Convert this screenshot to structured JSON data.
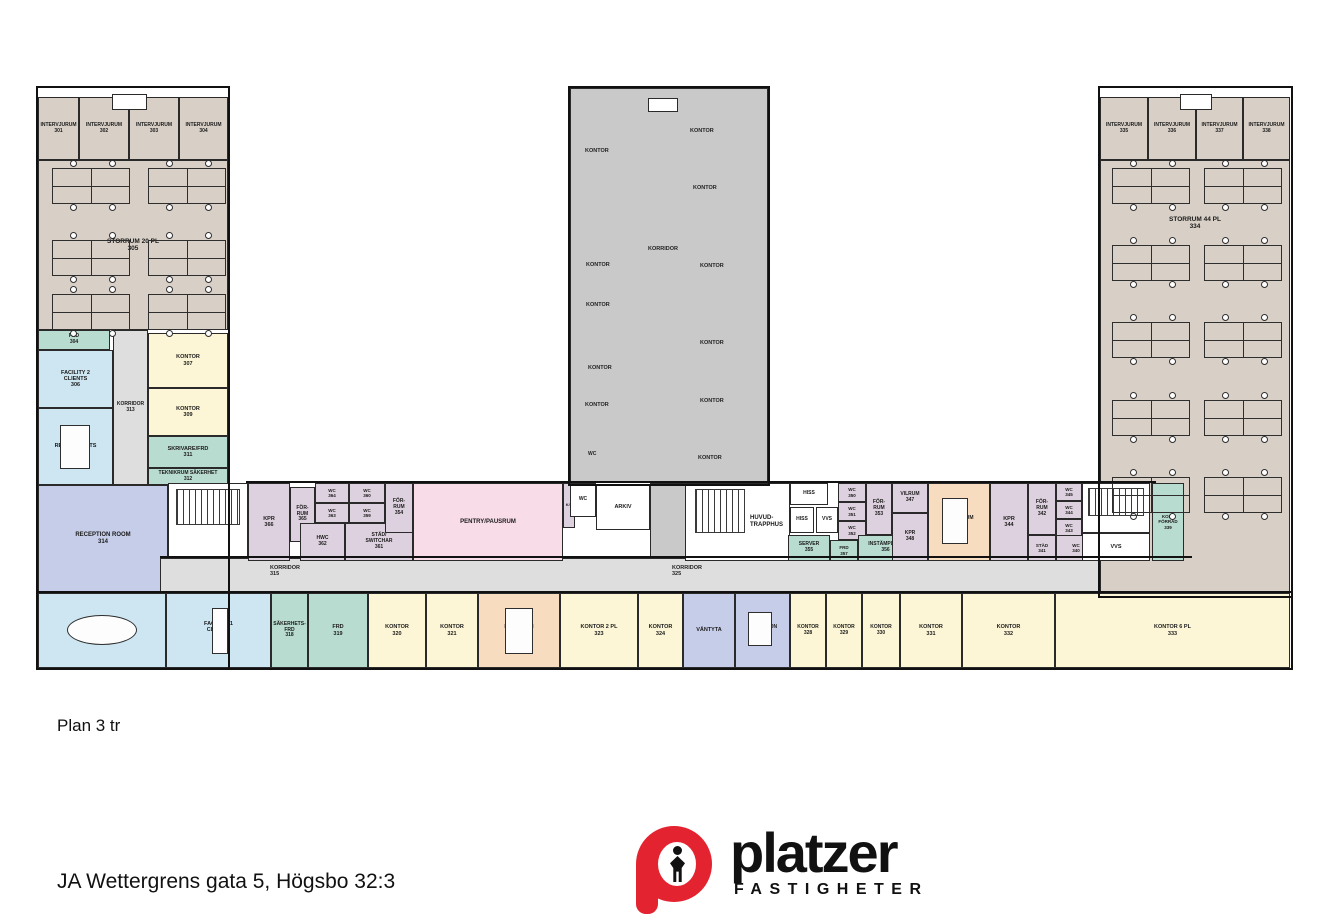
{
  "page": {
    "plan_label": "Plan 3 tr",
    "address": "JA Wettergrens gata 5, Högsbo 32:3"
  },
  "logo": {
    "brand": "platzer",
    "sub": "FASTIGHETER",
    "red": "#e42330"
  },
  "colors": {
    "beige": "#d8d0c7",
    "blue": "#cde6f2",
    "teal": "#b9dcd1",
    "yellow": "#fcf6d6",
    "pink": "#f8dce8",
    "mauve": "#ded1df",
    "lavender": "#c6cde8",
    "gray": "#dedede",
    "peach": "#f8dcc0",
    "white": "#ffffff",
    "hatch": "#c9c9c9"
  },
  "rooms": [
    {
      "id": "room-storrum-305",
      "x": 38,
      "y": 160,
      "w": 190,
      "h": 170,
      "fill": "beige",
      "label": "STORRUM 20 PL\n305",
      "fs": 6.5,
      "align": "center"
    },
    {
      "id": "room-intervjurum-301",
      "x": 38,
      "y": 97,
      "w": 41,
      "h": 63,
      "fill": "beige",
      "label": "INTERVJURUM\n301",
      "fs": 5
    },
    {
      "id": "room-intervjurum-302",
      "x": 79,
      "y": 97,
      "w": 50,
      "h": 63,
      "fill": "beige",
      "label": "INTERVJURUM\n302",
      "fs": 5
    },
    {
      "id": "room-intervjurum-303",
      "x": 129,
      "y": 97,
      "w": 50,
      "h": 63,
      "fill": "beige",
      "label": "INTERVJURUM\n303",
      "fs": 5
    },
    {
      "id": "room-intervjurum-304",
      "x": 179,
      "y": 97,
      "w": 49,
      "h": 63,
      "fill": "beige",
      "label": "INTERVJURUM\n304",
      "fs": 5
    },
    {
      "id": "room-frd-304",
      "x": 38,
      "y": 330,
      "w": 72,
      "h": 20,
      "fill": "teal",
      "label": "FRD\n304",
      "fs": 5
    },
    {
      "id": "room-facility-2-clients-306",
      "x": 38,
      "y": 350,
      "w": 75,
      "h": 58,
      "fill": "blue",
      "label": "FACILITY 2\nCLIENTS\n306",
      "fs": 5.5
    },
    {
      "id": "room-facility-2-respondents-310",
      "x": 38,
      "y": 408,
      "w": 75,
      "h": 77,
      "fill": "blue",
      "label": "FACILITY 2\nRESPONDENTS\n310",
      "fs": 5.5
    },
    {
      "id": "room-korridor-313",
      "x": 113,
      "y": 330,
      "w": 35,
      "h": 155,
      "fill": "gray",
      "label": "KORRIDOR\n313",
      "fs": 5
    },
    {
      "id": "room-kontor-307",
      "x": 148,
      "y": 333,
      "w": 80,
      "h": 55,
      "fill": "yellow",
      "label": "KONTOR\n307",
      "fs": 5.5
    },
    {
      "id": "room-kontor-309",
      "x": 148,
      "y": 388,
      "w": 80,
      "h": 48,
      "fill": "yellow",
      "label": "KONTOR\n309",
      "fs": 5.5
    },
    {
      "id": "room-skrivare-frd-311",
      "x": 148,
      "y": 436,
      "w": 80,
      "h": 32,
      "fill": "teal",
      "label": "SKRIVARE/FRD\n311",
      "fs": 5.5
    },
    {
      "id": "room-teknikrum-sakerhet-312",
      "x": 148,
      "y": 468,
      "w": 80,
      "h": 17,
      "fill": "teal",
      "label": "TEKNIKRUM SÄKERHET\n312",
      "fs": 5
    },
    {
      "id": "room-reception-room-314",
      "x": 38,
      "y": 485,
      "w": 130,
      "h": 108,
      "fill": "lavender",
      "label": "RECEPTION ROOM\n314",
      "fs": 6
    },
    {
      "id": "room-stairwell-west",
      "x": 168,
      "y": 483,
      "w": 80,
      "h": 80,
      "fill": "white"
    },
    {
      "id": "room-korridor-strip",
      "x": 160,
      "y": 558,
      "w": 1030,
      "h": 35,
      "fill": "gray"
    },
    {
      "id": "room-kpr-366",
      "x": 248,
      "y": 483,
      "w": 42,
      "h": 78,
      "fill": "mauve",
      "label": "KPR\n366",
      "fs": 5.5
    },
    {
      "id": "room-for-rum-365",
      "x": 290,
      "y": 487,
      "w": 25,
      "h": 55,
      "fill": "mauve",
      "label": "FÖR-\nRUM\n365",
      "fs": 5
    },
    {
      "id": "room-wc-364",
      "x": 315,
      "y": 483,
      "w": 34,
      "h": 20,
      "fill": "mauve",
      "label": "WC\n364",
      "fs": 4.5
    },
    {
      "id": "room-wc-363",
      "x": 315,
      "y": 503,
      "w": 34,
      "h": 20,
      "fill": "mauve",
      "label": "WC\n363",
      "fs": 4.5
    },
    {
      "id": "room-wc-360",
      "x": 349,
      "y": 483,
      "w": 36,
      "h": 20,
      "fill": "mauve",
      "label": "WC\n360",
      "fs": 4.5
    },
    {
      "id": "room-wc-359",
      "x": 349,
      "y": 503,
      "w": 36,
      "h": 20,
      "fill": "mauve",
      "label": "WC\n359",
      "fs": 4.5
    },
    {
      "id": "room-hwc-362",
      "x": 300,
      "y": 523,
      "w": 45,
      "h": 38,
      "fill": "mauve",
      "label": "HWC\n362",
      "fs": 5
    },
    {
      "id": "room-stad-switchar-361",
      "x": 345,
      "y": 523,
      "w": 68,
      "h": 38,
      "fill": "mauve",
      "label": "STÄD/\nSWITCHAR\n361",
      "fs": 5
    },
    {
      "id": "room-for-rum-354",
      "x": 385,
      "y": 483,
      "w": 28,
      "h": 50,
      "fill": "mauve",
      "label": "FÖR-\nRUM\n354",
      "fs": 5
    },
    {
      "id": "room-pentry-pausrum",
      "x": 413,
      "y": 483,
      "w": 150,
      "h": 78,
      "fill": "pink",
      "label": "PENTRY/PAUSRUM",
      "fs": 6
    },
    {
      "id": "room-kf-closet",
      "x": 563,
      "y": 483,
      "w": 12,
      "h": 45,
      "fill": "mauve",
      "label": "K/F",
      "fs": 4
    },
    {
      "id": "room-tower-hatched",
      "x": 570,
      "y": 88,
      "w": 198,
      "h": 395,
      "fill": "hatch",
      "hatch": true
    },
    {
      "id": "room-tower-hatched-wedge",
      "x": 650,
      "y": 483,
      "w": 38,
      "h": 76,
      "fill": "hatch",
      "hatch": true
    },
    {
      "id": "room-wc-tower",
      "x": 570,
      "y": 483,
      "w": 26,
      "h": 34,
      "fill": "white",
      "label": "WC",
      "fs": 5
    },
    {
      "id": "room-arkiv",
      "x": 596,
      "y": 485,
      "w": 54,
      "h": 45,
      "fill": "white",
      "label": "ARKIV",
      "fs": 5.5
    },
    {
      "id": "room-huvudtrapphus",
      "x": 685,
      "y": 483,
      "w": 105,
      "h": 78,
      "fill": "white",
      "label": "HUVUD-\nTRAPPHUS",
      "fs": 6,
      "labelRight": true
    },
    {
      "id": "room-hiss-1",
      "x": 790,
      "y": 483,
      "w": 38,
      "h": 22,
      "fill": "white",
      "label": "HISS",
      "fs": 5
    },
    {
      "id": "room-hiss-2",
      "x": 790,
      "y": 507,
      "w": 24,
      "h": 26,
      "fill": "white",
      "label": "HISS",
      "fs": 5
    },
    {
      "id": "room-vvs-mid",
      "x": 816,
      "y": 507,
      "w": 22,
      "h": 26,
      "fill": "white",
      "label": "VVS",
      "fs": 5
    },
    {
      "id": "room-server-355",
      "x": 788,
      "y": 535,
      "w": 42,
      "h": 26,
      "fill": "teal",
      "label": "SERVER\n355",
      "fs": 5
    },
    {
      "id": "room-wc-350",
      "x": 838,
      "y": 483,
      "w": 28,
      "h": 19,
      "fill": "mauve",
      "label": "WC\n350",
      "fs": 4.5
    },
    {
      "id": "room-wc-351",
      "x": 838,
      "y": 502,
      "w": 28,
      "h": 19,
      "fill": "mauve",
      "label": "WC\n351",
      "fs": 4.5
    },
    {
      "id": "room-wc-352",
      "x": 838,
      "y": 521,
      "w": 28,
      "h": 19,
      "fill": "mauve",
      "label": "WC\n352",
      "fs": 4.5
    },
    {
      "id": "room-frd-357",
      "x": 830,
      "y": 540,
      "w": 28,
      "h": 21,
      "fill": "teal",
      "label": "FRD\n357",
      "fs": 4.5
    },
    {
      "id": "room-instampling-356",
      "x": 858,
      "y": 535,
      "w": 55,
      "h": 26,
      "fill": "teal",
      "label": "INSTÄMPLING\n356",
      "fs": 5
    },
    {
      "id": "room-for-rum-353",
      "x": 866,
      "y": 483,
      "w": 26,
      "h": 52,
      "fill": "mauve",
      "label": "FÖR-\nRUM\n353",
      "fs": 5
    },
    {
      "id": "room-vilrum-347",
      "x": 892,
      "y": 483,
      "w": 36,
      "h": 30,
      "fill": "mauve",
      "label": "VILRUM\n347",
      "fs": 5
    },
    {
      "id": "room-kpr-348",
      "x": 892,
      "y": 513,
      "w": 36,
      "h": 48,
      "fill": "mauve",
      "label": "KPR\n348",
      "fs": 5
    },
    {
      "id": "room-motesrum-346",
      "x": 928,
      "y": 483,
      "w": 62,
      "h": 78,
      "fill": "peach",
      "label": "MÖTESRUM\n346",
      "fs": 5
    },
    {
      "id": "room-kpr-344",
      "x": 990,
      "y": 483,
      "w": 38,
      "h": 78,
      "fill": "mauve",
      "label": "KPR\n344",
      "fs": 5.5
    },
    {
      "id": "room-for-rum-342",
      "x": 1028,
      "y": 483,
      "w": 28,
      "h": 52,
      "fill": "mauve",
      "label": "FÖR-\nRUM\n342",
      "fs": 5
    },
    {
      "id": "room-wc-345",
      "x": 1056,
      "y": 483,
      "w": 26,
      "h": 18,
      "fill": "mauve",
      "label": "WC\n345",
      "fs": 4.5
    },
    {
      "id": "room-wc-344",
      "x": 1056,
      "y": 501,
      "w": 26,
      "h": 18,
      "fill": "mauve",
      "label": "WC\n344",
      "fs": 4.5
    },
    {
      "id": "room-wc-343",
      "x": 1056,
      "y": 519,
      "w": 26,
      "h": 18,
      "fill": "mauve",
      "label": "WC\n343",
      "fs": 4.5
    },
    {
      "id": "room-stad-341",
      "x": 1028,
      "y": 535,
      "w": 28,
      "h": 26,
      "fill": "mauve",
      "label": "STÄD\n341",
      "fs": 4.5
    },
    {
      "id": "room-wc-340",
      "x": 1056,
      "y": 535,
      "w": 40,
      "h": 26,
      "fill": "mauve",
      "label": "WC\n340",
      "fs": 4.5
    },
    {
      "id": "room-storrum-334",
      "x": 1100,
      "y": 160,
      "w": 190,
      "h": 435,
      "fill": "beige",
      "label": "STORRUM 44 PL\n334",
      "fs": 6.5,
      "labelTop": 55
    },
    {
      "id": "room-intervjurum-335",
      "x": 1100,
      "y": 97,
      "w": 48,
      "h": 63,
      "fill": "beige",
      "label": "INTERVJURUM\n335",
      "fs": 5
    },
    {
      "id": "room-intervjurum-336",
      "x": 1148,
      "y": 97,
      "w": 48,
      "h": 63,
      "fill": "beige",
      "label": "INTERVJURUM\n336",
      "fs": 5
    },
    {
      "id": "room-intervjurum-337",
      "x": 1196,
      "y": 97,
      "w": 47,
      "h": 63,
      "fill": "beige",
      "label": "INTERVJURUM\n337",
      "fs": 5
    },
    {
      "id": "room-intervjurum-338",
      "x": 1243,
      "y": 97,
      "w": 47,
      "h": 63,
      "fill": "beige",
      "label": "INTERVJURUM\n338",
      "fs": 5
    },
    {
      "id": "room-stairwell-east",
      "x": 1082,
      "y": 483,
      "w": 68,
      "h": 50,
      "fill": "white"
    },
    {
      "id": "room-vvs-east",
      "x": 1082,
      "y": 533,
      "w": 68,
      "h": 28,
      "fill": "white",
      "label": "VVS",
      "fs": 5.5
    },
    {
      "id": "room-kopi-forrad-339",
      "x": 1152,
      "y": 483,
      "w": 32,
      "h": 78,
      "fill": "teal",
      "label": "KOPI/\nFÖRRÅD\n339",
      "fs": 4.5
    },
    {
      "id": "room-facility-1-respondents",
      "x": 38,
      "y": 593,
      "w": 128,
      "h": 75,
      "fill": "blue",
      "label": "FACILITY 1\nRESPONDENTS",
      "fs": 5.5
    },
    {
      "id": "room-facility-1-clients-317",
      "x": 166,
      "y": 593,
      "w": 105,
      "h": 75,
      "fill": "blue",
      "label": "FACILITY 1\nCLIENTS\n317",
      "fs": 5.5
    },
    {
      "id": "room-sakerhets-frd-318",
      "x": 271,
      "y": 593,
      "w": 37,
      "h": 75,
      "fill": "teal",
      "label": "SÄKERHETS-\nFRD\n318",
      "fs": 5
    },
    {
      "id": "room-frd-319",
      "x": 308,
      "y": 593,
      "w": 60,
      "h": 75,
      "fill": "teal",
      "label": "FRD\n319",
      "fs": 5.5
    },
    {
      "id": "room-kontor-320",
      "x": 368,
      "y": 593,
      "w": 58,
      "h": 75,
      "fill": "yellow",
      "label": "KONTOR\n320",
      "fs": 5.5
    },
    {
      "id": "room-kontor-321",
      "x": 426,
      "y": 593,
      "w": 52,
      "h": 75,
      "fill": "yellow",
      "label": "KONTOR\n321",
      "fs": 5.5
    },
    {
      "id": "room-motesrum-322",
      "x": 478,
      "y": 593,
      "w": 82,
      "h": 75,
      "fill": "peach",
      "label": "MÖTESRUM\n322",
      "fs": 5
    },
    {
      "id": "room-kontor-2pl-323",
      "x": 560,
      "y": 593,
      "w": 78,
      "h": 75,
      "fill": "yellow",
      "label": "KONTOR 2 PL\n323",
      "fs": 5.5
    },
    {
      "id": "room-kontor-324",
      "x": 638,
      "y": 593,
      "w": 45,
      "h": 75,
      "fill": "yellow",
      "label": "KONTOR\n324",
      "fs": 5.5
    },
    {
      "id": "room-vantyta",
      "x": 683,
      "y": 593,
      "w": 52,
      "h": 75,
      "fill": "lavender",
      "label": "VÄNTYTA",
      "fs": 5.5
    },
    {
      "id": "room-reception-327",
      "x": 735,
      "y": 593,
      "w": 55,
      "h": 75,
      "fill": "lavender",
      "label": "RECEPTION\n327",
      "fs": 5
    },
    {
      "id": "room-kontor-328",
      "x": 790,
      "y": 593,
      "w": 36,
      "h": 75,
      "fill": "yellow",
      "label": "KONTOR\n328",
      "fs": 5
    },
    {
      "id": "room-kontor-329",
      "x": 826,
      "y": 593,
      "w": 36,
      "h": 75,
      "fill": "yellow",
      "label": "KONTOR\n329",
      "fs": 5
    },
    {
      "id": "room-kontor-330",
      "x": 862,
      "y": 593,
      "w": 38,
      "h": 75,
      "fill": "yellow",
      "label": "KONTOR\n330",
      "fs": 5
    },
    {
      "id": "room-kontor-331",
      "x": 900,
      "y": 593,
      "w": 62,
      "h": 75,
      "fill": "yellow",
      "label": "KONTOR\n331",
      "fs": 5.5
    },
    {
      "id": "room-kontor-332",
      "x": 962,
      "y": 593,
      "w": 93,
      "h": 75,
      "fill": "yellow",
      "label": "KONTOR\n332",
      "fs": 5.5
    },
    {
      "id": "room-kontor-6pl-333",
      "x": 1055,
      "y": 593,
      "w": 235,
      "h": 75,
      "fill": "yellow",
      "label": "KONTOR 6 PL\n333",
      "fs": 5.5
    },
    {
      "id": "roof-hatch-left",
      "x": 112,
      "y": 94,
      "w": 35,
      "h": 16,
      "fill": "white"
    },
    {
      "id": "roof-hatch-tower",
      "x": 648,
      "y": 98,
      "w": 30,
      "h": 14,
      "fill": "white"
    },
    {
      "id": "roof-hatch-right",
      "x": 1180,
      "y": 94,
      "w": 32,
      "h": 16,
      "fill": "white"
    }
  ],
  "floating_labels": [
    {
      "id": "label-korridor-315",
      "x": 270,
      "y": 565,
      "text": "KORRIDOR\n315",
      "fs": 5.5
    },
    {
      "id": "label-korridor-325",
      "x": 672,
      "y": 565,
      "text": "KORRIDOR\n325",
      "fs": 5.5
    },
    {
      "id": "label-tower-kontor-1",
      "x": 585,
      "y": 148,
      "text": "KONTOR",
      "fs": 5.5
    },
    {
      "id": "label-tower-kontor-2",
      "x": 690,
      "y": 128,
      "text": "KONTOR",
      "fs": 5.5
    },
    {
      "id": "label-tower-kontor-3",
      "x": 693,
      "y": 185,
      "text": "KONTOR",
      "fs": 5.5
    },
    {
      "id": "label-tower-korridor",
      "x": 648,
      "y": 246,
      "text": "KORRIDOR",
      "fs": 5.5
    },
    {
      "id": "label-tower-kontor-4",
      "x": 586,
      "y": 262,
      "text": "KONTOR",
      "fs": 5.5
    },
    {
      "id": "label-tower-kontor-5",
      "x": 586,
      "y": 302,
      "text": "KONTOR",
      "fs": 5.5
    },
    {
      "id": "label-tower-kontor-6",
      "x": 700,
      "y": 263,
      "text": "KONTOR",
      "fs": 5.5
    },
    {
      "id": "label-tower-kontor-7",
      "x": 588,
      "y": 365,
      "text": "KONTOR",
      "fs": 5.5
    },
    {
      "id": "label-tower-kontor-8",
      "x": 585,
      "y": 402,
      "text": "KONTOR",
      "fs": 5.5
    },
    {
      "id": "label-tower-kontor-9",
      "x": 700,
      "y": 340,
      "text": "KONTOR",
      "fs": 5.5
    },
    {
      "id": "label-tower-kontor-10",
      "x": 700,
      "y": 398,
      "text": "KONTOR",
      "fs": 5.5
    },
    {
      "id": "label-tower-kontor-11",
      "x": 698,
      "y": 455,
      "text": "KONTOR",
      "fs": 5.5
    },
    {
      "id": "label-tower-wc",
      "x": 588,
      "y": 452,
      "text": "WC",
      "fs": 5
    }
  ],
  "furniture": {
    "cluster_w": 78,
    "cluster_h": 36,
    "desk_clusters": [
      {
        "x": 52,
        "y": 168
      },
      {
        "x": 148,
        "y": 168
      },
      {
        "x": 52,
        "y": 240
      },
      {
        "x": 148,
        "y": 240
      },
      {
        "x": 52,
        "y": 294
      },
      {
        "x": 148,
        "y": 294
      },
      {
        "x": 1112,
        "y": 168
      },
      {
        "x": 1204,
        "y": 168
      },
      {
        "x": 1112,
        "y": 245
      },
      {
        "x": 1204,
        "y": 245
      },
      {
        "x": 1112,
        "y": 322
      },
      {
        "x": 1204,
        "y": 322
      },
      {
        "x": 1112,
        "y": 400
      },
      {
        "x": 1204,
        "y": 400
      },
      {
        "x": 1112,
        "y": 477
      },
      {
        "x": 1204,
        "y": 477
      }
    ],
    "tables": [
      {
        "x": 60,
        "y": 425,
        "w": 30,
        "h": 44
      },
      {
        "x": 505,
        "y": 608,
        "w": 28,
        "h": 46
      },
      {
        "x": 942,
        "y": 498,
        "w": 26,
        "h": 46
      },
      {
        "x": 212,
        "y": 608,
        "w": 16,
        "h": 46
      },
      {
        "x": 748,
        "y": 612,
        "w": 24,
        "h": 34
      }
    ],
    "oval_tables": [
      {
        "x": 67,
        "y": 615,
        "w": 70,
        "h": 30
      }
    ],
    "stairs": [
      {
        "x": 176,
        "y": 489,
        "w": 64,
        "h": 36
      },
      {
        "x": 695,
        "y": 489,
        "w": 50,
        "h": 44
      },
      {
        "x": 1088,
        "y": 488,
        "w": 56,
        "h": 28
      }
    ]
  },
  "outlines": [
    {
      "x": 36,
      "y": 86,
      "w": 194,
      "h": 584
    },
    {
      "x": 568,
      "y": 86,
      "w": 202,
      "h": 400
    },
    {
      "x": 1098,
      "y": 86,
      "w": 195,
      "h": 512
    },
    {
      "x": 36,
      "y": 591,
      "w": 1257,
      "h": 79
    }
  ],
  "walllines": [
    {
      "x": 246,
      "y": 481,
      "w": 910,
      "h": 2
    },
    {
      "x": 160,
      "y": 556,
      "w": 1032,
      "h": 2
    }
  ]
}
